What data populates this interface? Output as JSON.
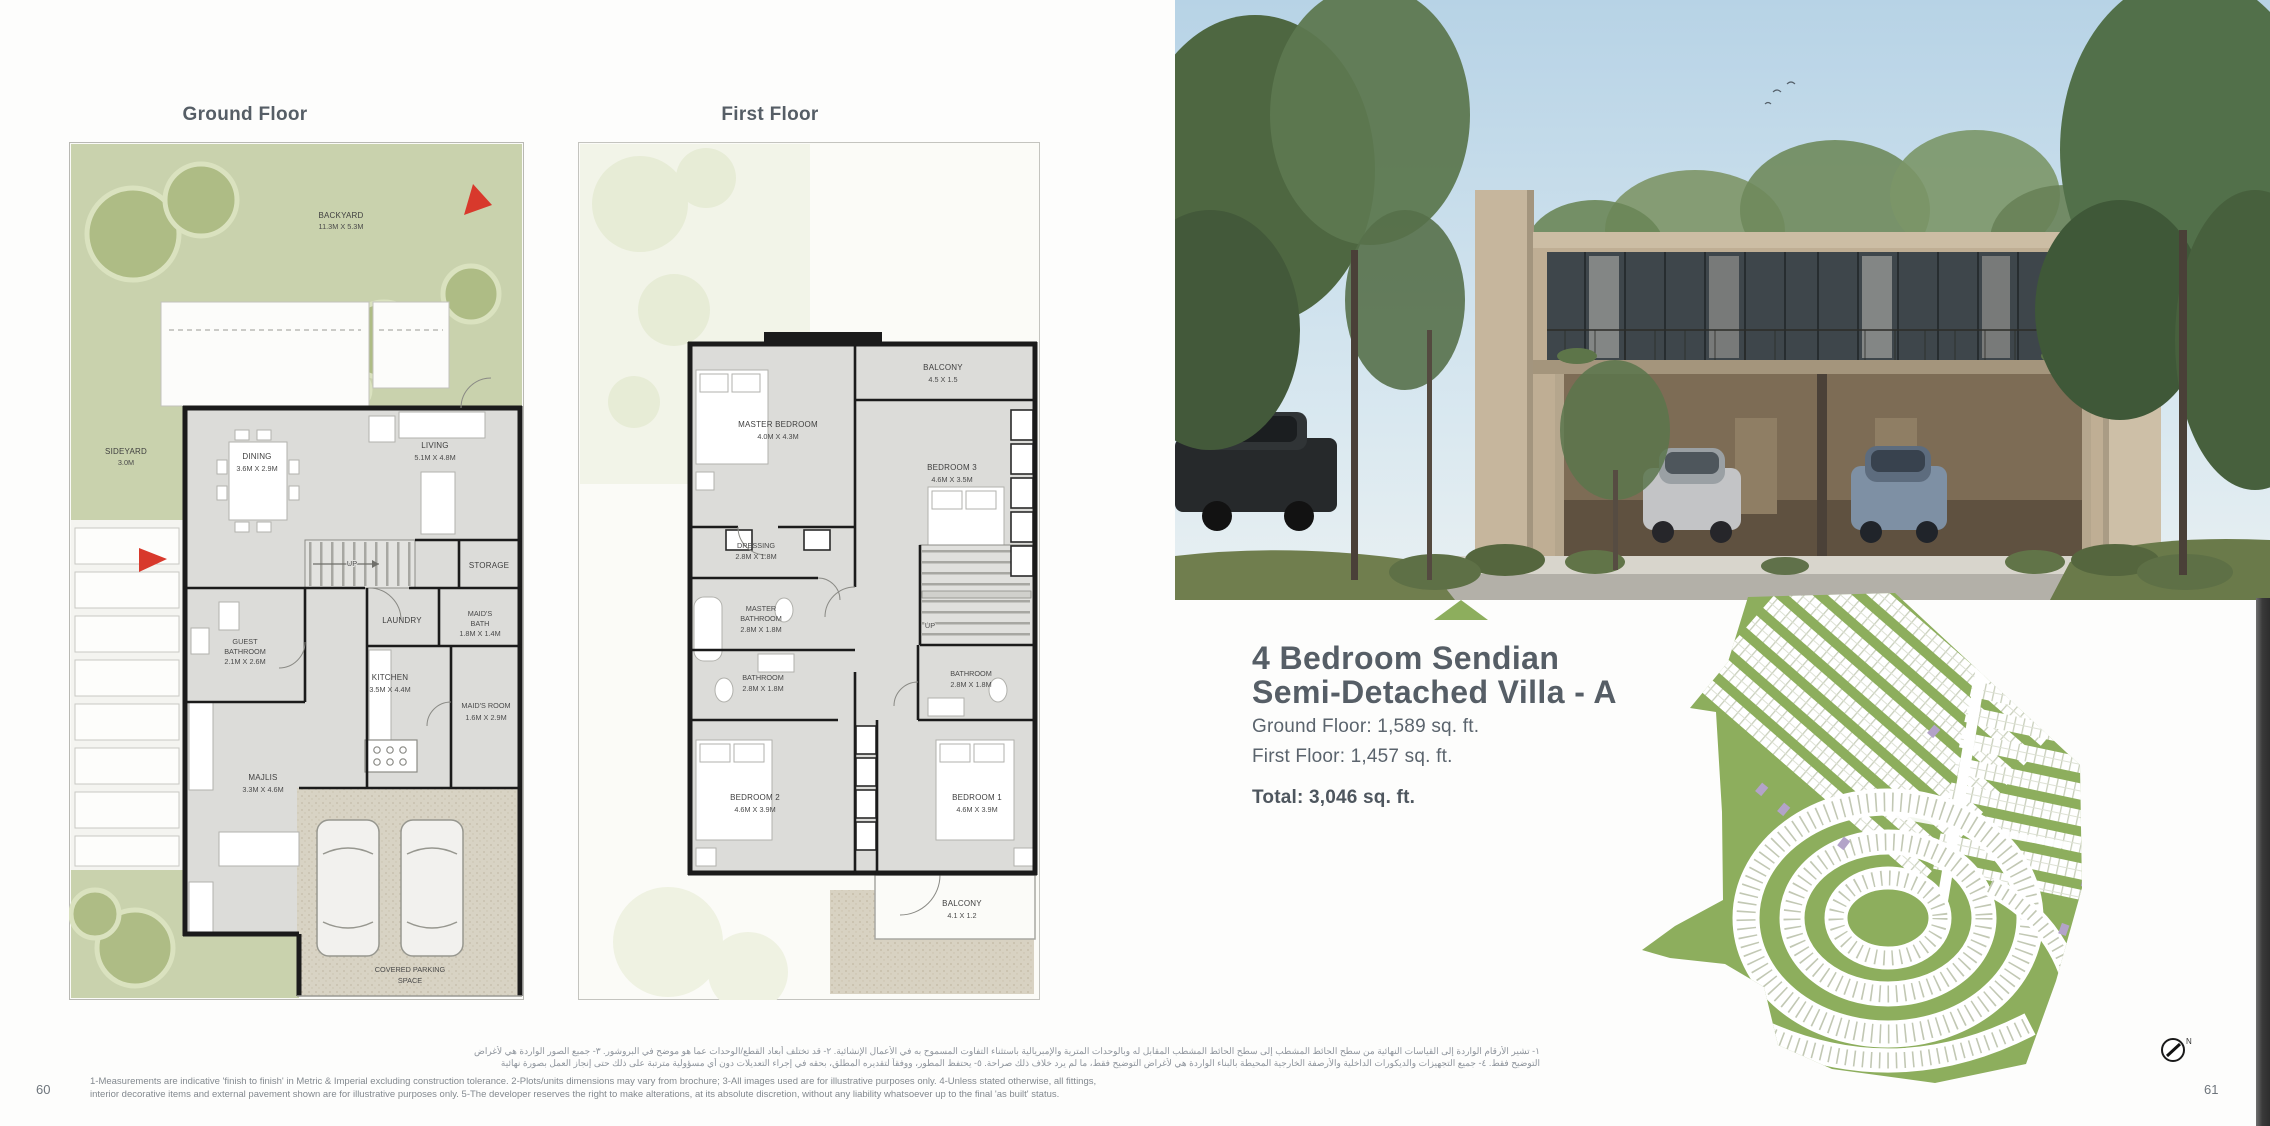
{
  "page": {
    "left_number": "60",
    "right_number": "61"
  },
  "ground_floor": {
    "title": "Ground Floor",
    "backyard_name": "BACKYARD",
    "backyard_dims": "11.3M X 5.3M",
    "sideyard_name": "SIDEYARD",
    "sideyard_dims": "3.0M",
    "dining_name": "DINING",
    "dining_dims": "3.6M X 2.9M",
    "living_name": "LIVING",
    "living_dims": "5.1M X 4.8M",
    "up_label": "UP",
    "storage_name": "STORAGE",
    "laundry_name": "LAUNDRY",
    "maids_bath_name1": "MAID'S",
    "maids_bath_name2": "BATH",
    "maids_bath_dims": "1.8M X 1.4M",
    "kitchen_name": "KITCHEN",
    "kitchen_dims": "3.5M X 4.4M",
    "maids_room_name": "MAID'S ROOM",
    "maids_room_dims": "1.6M X 2.9M",
    "guest_bath_name1": "GUEST",
    "guest_bath_name2": "BATHROOM",
    "guest_bath_dims": "2.1M X 2.6M",
    "majlis_name": "MAJLIS",
    "majlis_dims": "3.3M X 4.6M",
    "parking_name1": "COVERED PARKING",
    "parking_name2": "SPACE"
  },
  "first_floor": {
    "title": "First Floor",
    "balcony_top_name": "BALCONY",
    "balcony_top_dims": "4.5 X 1.5",
    "master_bedroom_name": "MASTER BEDROOM",
    "master_bedroom_dims": "4.0M X 4.3M",
    "bedroom3_name": "BEDROOM 3",
    "bedroom3_dims": "4.6M X 3.5M",
    "dressing_name": "DRESSING",
    "dressing_dims": "2.8M X 1.8M",
    "master_bath_name1": "MASTER",
    "master_bath_name2": "BATHROOM",
    "master_bath_dims": "2.8M X 1.8M",
    "up_label": "UP",
    "bathroom_left_name": "BATHROOM",
    "bathroom_left_dims": "2.8M X 1.8M",
    "bathroom_right_name": "BATHROOM",
    "bathroom_right_dims": "2.8M X 1.8M",
    "bedroom2_name": "BEDROOM 2",
    "bedroom2_dims": "4.6M X 3.9M",
    "bedroom1_name": "BEDROOM 1",
    "bedroom1_dims": "4.6M X 3.9M",
    "balcony_bottom_name": "BALCONY",
    "balcony_bottom_dims": "4.1 X 1.2"
  },
  "details": {
    "title_line1": "4 Bedroom Sendian",
    "title_line2": "Semi-Detached Villa - A",
    "ground_floor_area": "Ground Floor: 1,589 sq. ft.",
    "first_floor_area": "First Floor: 1,457 sq. ft.",
    "total_area": "Total: 3,046 sq. ft."
  },
  "site_map": {
    "compass_n": "N"
  },
  "footer": {
    "arabic_line1": "١- تشير الأرقام الواردة إلى القياسات النهائية من سطح الحائط المشطب إلى سطح الحائط المشطب المقابل له وبالوحدات المترية والإمبريالية باستثناء التفاوت المسموح به في الأعمال الإنشائية. ٢- قد تختلف أبعاد القطع/الوحدات عما هو موضح في البروشور. ٣- جميع الصور الواردة هي لأغراض",
    "arabic_line2": "التوضيح فقط. ٤- جميع التجهيزات والديكورات الداخلية والأرصفة الخارجية المحيطة بالبناء الواردة هي لأغراض التوضيح فقط، ما لم يرد خلاف ذلك صراحة. ٥- يحتفظ المطور، ووفقاً لتقديره المطلق، بحقه في إجراء التعديلات دون أي مسؤولية مترتبة على ذلك حتى إنجاز العمل بصورة نهائية",
    "english_line1": "1-Measurements are indicative 'finish to finish' in Metric & Imperial excluding construction tolerance. 2-Plots/units dimensions may vary from brochure; 3-All images used are for illustrative purposes only. 4-Unless stated otherwise, all fittings,",
    "english_line2": "interior decorative items and external pavement shown are for illustrative purposes only. 5-The developer reserves the right to make alterations, at its absolute discretion, without any liability whatsoever up to the final 'as built' status."
  },
  "colors": {
    "accent_green": "#8dae5d",
    "plan_garden_green": "#c9d2ad",
    "wall_black": "#1b1b1b",
    "heading_gray": "#565e66",
    "red_arrow": "#d8392c"
  }
}
